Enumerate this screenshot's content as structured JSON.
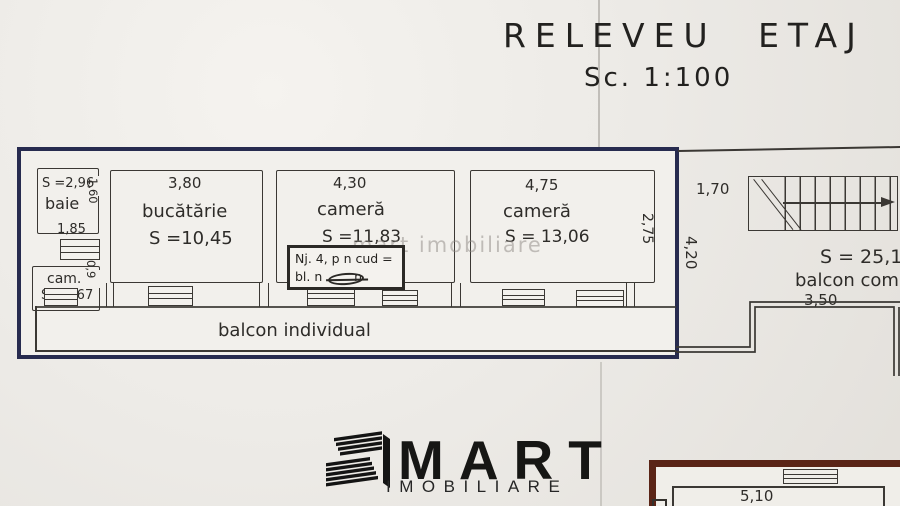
{
  "document": {
    "title": "RELEVEU ETAJ",
    "scale": "Sc. 1:100"
  },
  "watermark_text": "mart imobiliare",
  "plan": {
    "rooms": {
      "baie": {
        "name": "baie",
        "area": "S =2,96",
        "door_width": "1,60"
      },
      "cam": {
        "name": "cam.",
        "area": "S =1,67",
        "door_width": "0,9",
        "window_width": "1,85"
      },
      "bucatarie": {
        "name": "bucătărie",
        "area": "S =10,45",
        "width": "3,80"
      },
      "camera1": {
        "name": "cameră",
        "area": "S =11,83",
        "width": "4,30"
      },
      "camera2": {
        "name": "cameră",
        "area": "S = 13,06",
        "width": "4,75",
        "depth": "2,75"
      },
      "balcon_individual": {
        "name": "balcon individual"
      }
    },
    "note": {
      "line1": "Nj. 4, p n cud =",
      "line2": "bl. n        n"
    },
    "common": {
      "entry_width": "1,70",
      "depth": "4,20",
      "area": "S = 25,17",
      "name": "balcon comun",
      "balcony_width": "3,50"
    },
    "lower_unit": {
      "width": "5,10"
    }
  },
  "logo": {
    "brand": "MART",
    "tagline": "IMOBILIARE"
  },
  "colors": {
    "unit_outline": "#272b4f",
    "pencil": "#3b3834",
    "lower_outline": "#5a2416",
    "paper": "#edebe7"
  }
}
